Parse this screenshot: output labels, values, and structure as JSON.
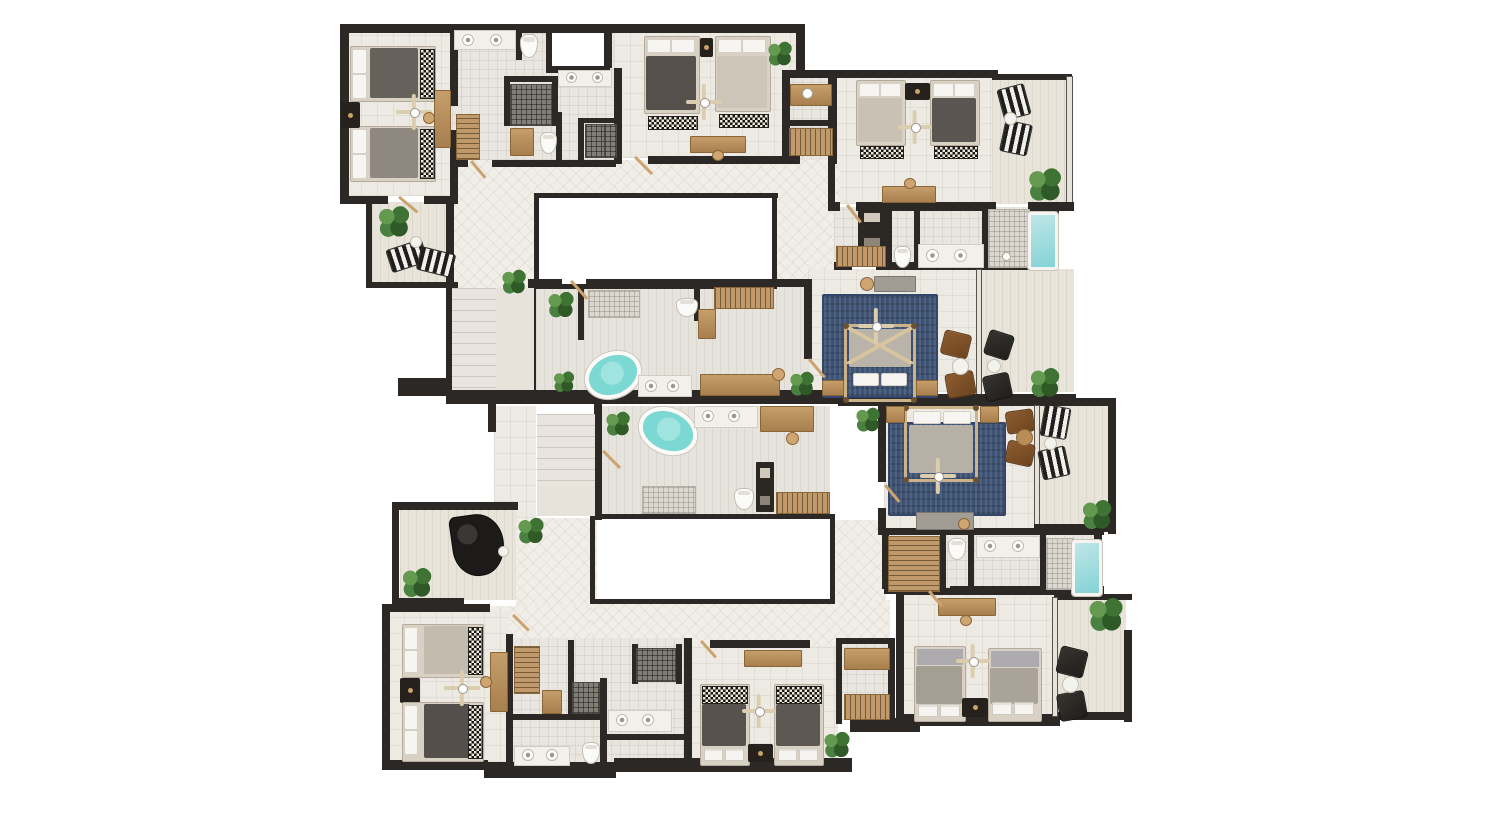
{
  "page": {
    "background": "#ffffff",
    "description": "Top-down 3D rendered architectural floor plan of two mirrored residential units arranged around two open courtyards. No text labels are rendered in the image."
  },
  "colors": {
    "background": "#ffffff",
    "wall": "#2b2826",
    "floor_tile": "#edeae4",
    "hall_floor": "#f1eee8",
    "balcony_floor": "#e9e4da",
    "courtyard": "#ffffff",
    "water_teal": "#7cd8d3",
    "pool_teal": "#84d3d5",
    "rug_blue": "#3e5373",
    "plant_green": "#386628",
    "wood": "#dccdae",
    "bed_frame": "#d8d1c4",
    "pillow_white": "#f7f5f1",
    "bedding_dark": "#57524d",
    "bedding_light": "#ccc5b8",
    "leather_brown": "#7d4f28",
    "chair_black": "#2a2a28"
  },
  "floor_plan": {
    "view": "top-down-render",
    "units": [
      {
        "name": "upper-unit",
        "rooms": [
          "twin-bedroom-left",
          "bathroom-cluster-left",
          "walk-in-wardrobe",
          "twin-bedroom-center",
          "dressing-room",
          "twin-bedroom-right",
          "balcony-right",
          "bathroom-right-with-plunge-pool",
          "left-balcony",
          "staircase",
          "hallway",
          "courtyard",
          "master-bathroom",
          "master-bedroom",
          "sitting-terrace"
        ]
      },
      {
        "name": "lower-unit",
        "rooms": [
          "staircase",
          "hallway",
          "piano-terrace",
          "master-bathroom",
          "walk-in-closet",
          "master-bedroom",
          "balcony-right",
          "family-bathroom-with-plunge-pool",
          "twin-bedroom-right",
          "balcony-bottom-right",
          "twin-bedroom-center",
          "bathroom-cluster-center",
          "twin-bedroom-left",
          "courtyard"
        ]
      }
    ],
    "furniture_inventory": {
      "standard_beds": 12,
      "four_poster_beds": 2,
      "freestanding_oval_bathtubs": 2,
      "plunge_pools": 2,
      "showers": 7,
      "toilets": 7,
      "sink_basins": 16,
      "ceiling_fans": 8,
      "blue_area_rugs": 2,
      "potted_plants": 16,
      "striped_sun_loungers": 6,
      "brown_lounge_chairs": 4,
      "black_lounge_chairs": 4,
      "desks_and_vanities": 10,
      "wardrobes_and_racks": 11,
      "grand_piano": 1,
      "staircases": 2,
      "courtyard_voids": 2
    }
  }
}
